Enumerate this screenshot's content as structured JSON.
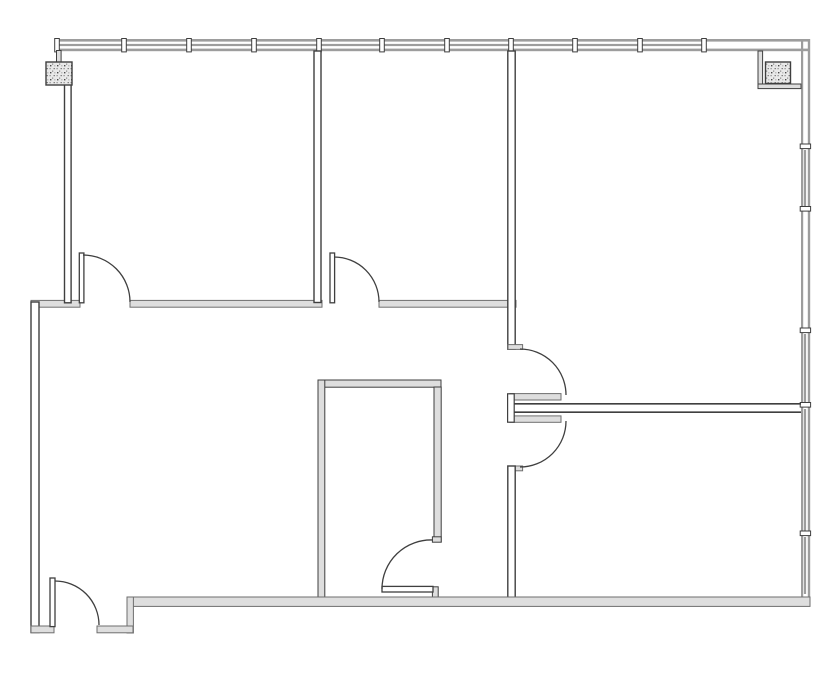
{
  "document": {
    "type": "architectural-floor-plan",
    "description": "black-and-white CAD floor plan, five rooms with closet, window walls on top and right, two hatched structural columns, six door swings"
  },
  "canvas": {
    "width": 835,
    "height": 678,
    "background": "#ffffff"
  },
  "palette": {
    "line": "#3f3f3f",
    "gray": "#9d9d9d",
    "wallFill": "#dedede",
    "wallStroke": "#6e6e6e",
    "white": "#ffffff"
  },
  "shapes": [
    {
      "type": "rect",
      "name": "top-window-wall-outer-line",
      "x": 57,
      "y": 39,
      "w": 751,
      "h": 2.6,
      "fill": "gray"
    },
    {
      "type": "rect",
      "name": "top-window-wall-inner-line",
      "x": 57,
      "y": 48.6,
      "w": 751,
      "h": 2.6,
      "fill": "gray"
    },
    {
      "type": "rect",
      "name": "top-window-glazing-line",
      "x": 57,
      "y": 43.9,
      "w": 648,
      "h": 2.2,
      "fill": "gray"
    },
    {
      "type": "rect",
      "name": "top-window-mullion",
      "x": 54.7,
      "y": 38.5,
      "w": 4.6,
      "h": 13.4,
      "fill": "white",
      "stroke": "line",
      "sw": 1
    },
    {
      "type": "rect",
      "name": "top-window-mullion",
      "x": 121.7,
      "y": 38.5,
      "w": 4.6,
      "h": 13.4,
      "fill": "white",
      "stroke": "line",
      "sw": 1
    },
    {
      "type": "rect",
      "name": "top-window-mullion",
      "x": 186.7,
      "y": 38.5,
      "w": 4.6,
      "h": 13.4,
      "fill": "white",
      "stroke": "line",
      "sw": 1
    },
    {
      "type": "rect",
      "name": "top-window-mullion",
      "x": 251.7,
      "y": 38.5,
      "w": 4.6,
      "h": 13.4,
      "fill": "white",
      "stroke": "line",
      "sw": 1
    },
    {
      "type": "rect",
      "name": "top-window-mullion",
      "x": 316.7,
      "y": 38.5,
      "w": 4.6,
      "h": 13.4,
      "fill": "white",
      "stroke": "line",
      "sw": 1
    },
    {
      "type": "rect",
      "name": "top-window-mullion",
      "x": 379.7,
      "y": 38.5,
      "w": 4.6,
      "h": 13.4,
      "fill": "white",
      "stroke": "line",
      "sw": 1
    },
    {
      "type": "rect",
      "name": "top-window-mullion",
      "x": 444.7,
      "y": 38.5,
      "w": 4.6,
      "h": 13.4,
      "fill": "white",
      "stroke": "line",
      "sw": 1
    },
    {
      "type": "rect",
      "name": "top-window-mullion",
      "x": 508.7,
      "y": 38.5,
      "w": 4.6,
      "h": 13.4,
      "fill": "white",
      "stroke": "line",
      "sw": 1
    },
    {
      "type": "rect",
      "name": "top-window-mullion",
      "x": 572.7,
      "y": 38.5,
      "w": 4.6,
      "h": 13.4,
      "fill": "white",
      "stroke": "line",
      "sw": 1
    },
    {
      "type": "rect",
      "name": "top-window-mullion",
      "x": 637.7,
      "y": 38.5,
      "w": 4.6,
      "h": 13.4,
      "fill": "white",
      "stroke": "line",
      "sw": 1
    },
    {
      "type": "rect",
      "name": "top-window-mullion",
      "x": 701.7,
      "y": 38.5,
      "w": 4.6,
      "h": 13.4,
      "fill": "white",
      "stroke": "line",
      "sw": 1
    },
    {
      "type": "rect",
      "name": "right-window-wall-inner-line",
      "x": 801,
      "y": 39,
      "w": 2.2,
      "h": 562,
      "fill": "gray"
    },
    {
      "type": "rect",
      "name": "right-window-wall-outer-line",
      "x": 807.8,
      "y": 39,
      "w": 2.4,
      "h": 562,
      "fill": "gray"
    },
    {
      "type": "rect",
      "name": "right-window-glazing-line",
      "x": 803.9,
      "y": 150,
      "w": 2.2,
      "h": 58,
      "fill": "gray"
    },
    {
      "type": "rect",
      "name": "right-window-glazing-line",
      "x": 803.9,
      "y": 334,
      "w": 2.2,
      "h": 68.5,
      "fill": "gray"
    },
    {
      "type": "rect",
      "name": "right-window-glazing-line",
      "x": 803.9,
      "y": 409,
      "w": 2.2,
      "h": 122,
      "fill": "gray"
    },
    {
      "type": "rect",
      "name": "right-window-glazing-line",
      "x": 803.9,
      "y": 537,
      "w": 2.2,
      "h": 57,
      "fill": "gray"
    },
    {
      "type": "rect",
      "name": "right-window-mullion",
      "x": 800.2,
      "y": 144,
      "w": 10.4,
      "h": 4.6,
      "fill": "white",
      "stroke": "line",
      "sw": 1
    },
    {
      "type": "rect",
      "name": "right-window-mullion",
      "x": 800.2,
      "y": 206.5,
      "w": 10.4,
      "h": 4.6,
      "fill": "white",
      "stroke": "line",
      "sw": 1
    },
    {
      "type": "rect",
      "name": "right-window-mullion",
      "x": 800.2,
      "y": 328,
      "w": 10.4,
      "h": 4.6,
      "fill": "white",
      "stroke": "line",
      "sw": 1
    },
    {
      "type": "rect",
      "name": "right-window-mullion",
      "x": 800.2,
      "y": 402.5,
      "w": 10.4,
      "h": 4.6,
      "fill": "white",
      "stroke": "line",
      "sw": 1
    },
    {
      "type": "rect",
      "name": "right-window-mullion",
      "x": 800.2,
      "y": 531,
      "w": 10.4,
      "h": 4.6,
      "fill": "white",
      "stroke": "line",
      "sw": 1
    },
    {
      "type": "rect",
      "name": "column-nook-wall-vertical",
      "x": 758,
      "y": 51,
      "w": 4.6,
      "h": 37.5,
      "fill": "wallFill",
      "stroke": "line",
      "sw": 1
    },
    {
      "type": "rect",
      "name": "column-nook-wall-horizontal",
      "x": 758,
      "y": 84,
      "w": 43,
      "h": 4.6,
      "fill": "wallFill",
      "stroke": "line",
      "sw": 1
    },
    {
      "type": "rect",
      "name": "left-column-stub",
      "x": 56.5,
      "y": 50.5,
      "w": 4.6,
      "h": 12.5,
      "fill": "wallFill",
      "stroke": "line",
      "sw": 1
    },
    {
      "type": "rect",
      "name": "west-jog-wall",
      "x": 31,
      "y": 300.4,
      "w": 49,
      "h": 6.8,
      "fill": "wallFill",
      "stroke": "wallStroke",
      "sw": 1
    },
    {
      "type": "rect",
      "name": "room-divider-wall-left",
      "x": 130,
      "y": 300.4,
      "w": 192,
      "h": 6.8,
      "fill": "wallFill",
      "stroke": "wallStroke",
      "sw": 1
    },
    {
      "type": "rect",
      "name": "room-divider-wall-right",
      "x": 379,
      "y": 300.4,
      "w": 137,
      "h": 6.8,
      "fill": "wallFill",
      "stroke": "wallStroke",
      "sw": 1
    },
    {
      "type": "rect",
      "name": "west-wall-upper",
      "x": 64.5,
      "y": 84,
      "w": 6.6,
      "h": 218.8,
      "fill": "white",
      "stroke": "line",
      "sw": 1.4
    },
    {
      "type": "rect",
      "name": "west-wall-lower",
      "x": 31,
      "y": 302,
      "w": 8,
      "h": 330.5,
      "fill": "white",
      "stroke": "line",
      "sw": 1.4
    },
    {
      "type": "rect",
      "name": "partition-wall-room1-room2",
      "x": 314,
      "y": 51,
      "w": 7,
      "h": 251.5,
      "fill": "white",
      "stroke": "line",
      "sw": 1.4
    },
    {
      "type": "rect",
      "name": "corridor-wall-upper",
      "x": 507.8,
      "y": 51,
      "w": 7.4,
      "h": 298.2,
      "fill": "white",
      "stroke": "line",
      "sw": 1.4
    },
    {
      "type": "rect",
      "name": "door-header-stub-upper",
      "x": 508,
      "y": 344.6,
      "w": 14.6,
      "h": 4.8,
      "fill": "wallFill",
      "stroke": "wallStroke",
      "sw": 1
    },
    {
      "type": "rect",
      "name": "double-door-leaf-upper",
      "x": 510,
      "y": 393.6,
      "w": 51,
      "h": 6.4,
      "fill": "wallFill",
      "stroke": "wallStroke",
      "sw": 1
    },
    {
      "type": "rect",
      "name": "double-door-leaf-lower",
      "x": 510,
      "y": 415.9,
      "w": 51,
      "h": 6.4,
      "fill": "wallFill",
      "stroke": "wallStroke",
      "sw": 1
    },
    {
      "type": "rect",
      "name": "door-header-stub-lower",
      "x": 508,
      "y": 466,
      "w": 14.6,
      "h": 4.8,
      "fill": "wallFill",
      "stroke": "wallStroke",
      "sw": 1
    },
    {
      "type": "line",
      "name": "hall-divider-wall-top-line",
      "x1": 513.5,
      "y1": 403.8,
      "x2": 801,
      "y2": 403.8,
      "stroke": "line",
      "sw": 1.7
    },
    {
      "type": "line",
      "name": "hall-divider-wall-bottom-line",
      "x1": 513.5,
      "y1": 412.2,
      "x2": 801,
      "y2": 412.2,
      "stroke": "line",
      "sw": 1.7
    },
    {
      "type": "rect",
      "name": "hall-divider-wall-end-cap",
      "x": 507.6,
      "y": 393.8,
      "w": 6.6,
      "h": 28.4,
      "fill": "white",
      "stroke": "line",
      "sw": 1.2
    },
    {
      "type": "rect",
      "name": "corridor-wall-lower",
      "x": 507.8,
      "y": 466,
      "w": 7.4,
      "h": 135.5,
      "fill": "white",
      "stroke": "line",
      "sw": 1.4
    },
    {
      "type": "rect",
      "name": "closet-top-wall",
      "x": 318,
      "y": 380,
      "w": 123,
      "h": 7.2,
      "fill": "wallFill",
      "stroke": "line",
      "sw": 1
    },
    {
      "type": "rect",
      "name": "closet-west-wall",
      "x": 318,
      "y": 380,
      "w": 6.8,
      "h": 217.5,
      "fill": "wallFill",
      "stroke": "line",
      "sw": 1
    },
    {
      "type": "rect",
      "name": "closet-east-wall",
      "x": 434,
      "y": 387,
      "w": 7.2,
      "h": 155,
      "fill": "wallFill",
      "stroke": "line",
      "sw": 1
    },
    {
      "type": "rect",
      "name": "closet-east-wall-end-cap",
      "x": 432.4,
      "y": 536.8,
      "w": 8.8,
      "h": 5.4,
      "fill": "wallFill",
      "stroke": "line",
      "sw": 1
    },
    {
      "type": "rect",
      "name": "closet-door-jamb",
      "x": 432.4,
      "y": 586.8,
      "w": 5.8,
      "h": 10.5,
      "fill": "wallFill",
      "stroke": "line",
      "sw": 1
    },
    {
      "type": "rect",
      "name": "south-wall-main",
      "x": 127,
      "y": 597,
      "w": 683,
      "h": 9.4,
      "fill": "wallFill",
      "stroke": "wallStroke",
      "sw": 1
    },
    {
      "type": "rect",
      "name": "south-wall-step",
      "x": 127,
      "y": 597,
      "w": 6.4,
      "h": 36,
      "fill": "wallFill",
      "stroke": "wallStroke",
      "sw": 1
    },
    {
      "type": "rect",
      "name": "south-wall-entry-left",
      "x": 31,
      "y": 626,
      "w": 23,
      "h": 6.8,
      "fill": "wallFill",
      "stroke": "wallStroke",
      "sw": 1
    },
    {
      "type": "rect",
      "name": "south-wall-entry-right",
      "x": 97,
      "y": 626,
      "w": 36,
      "h": 6.8,
      "fill": "wallFill",
      "stroke": "wallStroke",
      "sw": 1
    },
    {
      "type": "rect",
      "name": "left-structural-column",
      "x": 46,
      "y": 62,
      "w": 26,
      "h": 23,
      "fill": "speckle",
      "stroke": "line",
      "sw": 1.4
    },
    {
      "type": "rect",
      "name": "right-structural-column",
      "x": 765.5,
      "y": 62,
      "w": 25,
      "h": 21.5,
      "fill": "speckle",
      "stroke": "line",
      "sw": 1.4
    },
    {
      "type": "rect",
      "name": "room1-door-leaf",
      "x": 79.3,
      "y": 253,
      "w": 4.6,
      "h": 49.8,
      "fill": "white",
      "stroke": "line",
      "sw": 1.3
    },
    {
      "type": "path",
      "name": "room1-door-arc",
      "d": "M 83 255 A 47 47 0 0 1 130 302",
      "stroke": "line",
      "sw": 1.3
    },
    {
      "type": "rect",
      "name": "room2-door-leaf",
      "x": 330,
      "y": 253,
      "w": 4.6,
      "h": 49.8,
      "fill": "white",
      "stroke": "line",
      "sw": 1.3
    },
    {
      "type": "path",
      "name": "room2-door-arc",
      "d": "M 334 257 A 45 45 0 0 1 379 302",
      "stroke": "line",
      "sw": 1.3
    },
    {
      "type": "path",
      "name": "upper-right-door-arc",
      "d": "M 520 349 A 46 46 0 0 1 566 395",
      "stroke": "line",
      "sw": 1.3
    },
    {
      "type": "path",
      "name": "lower-right-door-arc",
      "d": "M 566 421 A 46 46 0 0 1 520 467",
      "stroke": "line",
      "sw": 1.3
    },
    {
      "type": "rect",
      "name": "closet-door-leaf",
      "x": 382,
      "y": 586.4,
      "w": 51,
      "h": 5.6,
      "fill": "white",
      "stroke": "line",
      "sw": 1.3
    },
    {
      "type": "path",
      "name": "closet-door-arc",
      "d": "M 382 589 A 49 49 0 0 1 433 540",
      "stroke": "line",
      "sw": 1.3
    },
    {
      "type": "rect",
      "name": "entry-door-leaf",
      "x": 50,
      "y": 578,
      "w": 5,
      "h": 48.6,
      "fill": "white",
      "stroke": "line",
      "sw": 1.3
    },
    {
      "type": "path",
      "name": "entry-door-arc",
      "d": "M 55 581 A 44 44 0 0 1 99 625",
      "stroke": "line",
      "sw": 1.3
    }
  ]
}
